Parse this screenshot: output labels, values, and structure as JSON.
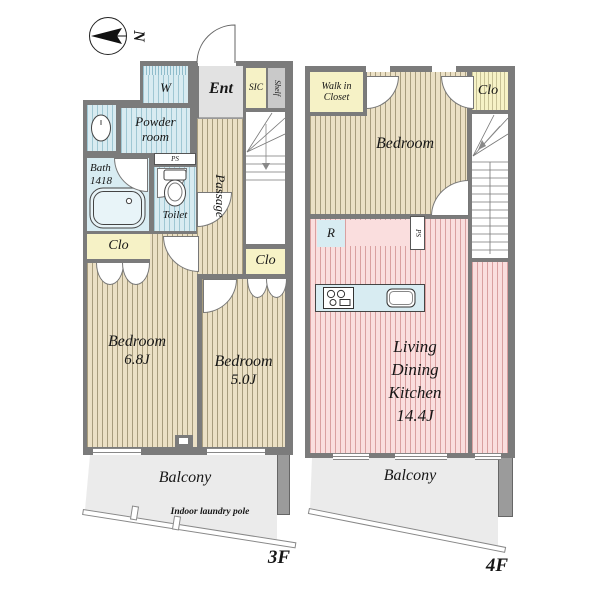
{
  "compass": {
    "north_label": "N"
  },
  "floor_3f": {
    "label": "3F",
    "entrance": "Ent",
    "shoe_closet": "SIC",
    "shelf": "Shelf",
    "washer": "W",
    "powder_room": [
      "Powder",
      "room"
    ],
    "bath": [
      "Bath",
      "1418"
    ],
    "pipe_space": "PS",
    "toilet": "Toilet",
    "passage": "Passage",
    "closet_left": "Clo",
    "closet_right": "Clo",
    "bedroom_a": {
      "name": "Bedroom",
      "size": "6.8J"
    },
    "bedroom_b": {
      "name": "Bedroom",
      "size": "5.0J"
    },
    "balcony": "Balcony",
    "laundry_note": "Indoor laundry pole"
  },
  "floor_4f": {
    "label": "4F",
    "walk_in_closet": [
      "Walk in",
      "Closet"
    ],
    "bedroom": "Bedroom",
    "closet": "Clo",
    "refrigerator": "R",
    "pipe_space": "PS",
    "ldk": [
      "Living",
      "Dining",
      "Kitchen",
      "14.4J"
    ],
    "balcony": "Balcony"
  },
  "colors": {
    "wall": "#7b7b7b",
    "room_tan": "#ebe0c5",
    "wet_blue": "#d8ebf1",
    "closet_yellow": "#f6f2c6",
    "ldk_pink": "#fadede",
    "balcony_gray": "#ebebeb"
  }
}
